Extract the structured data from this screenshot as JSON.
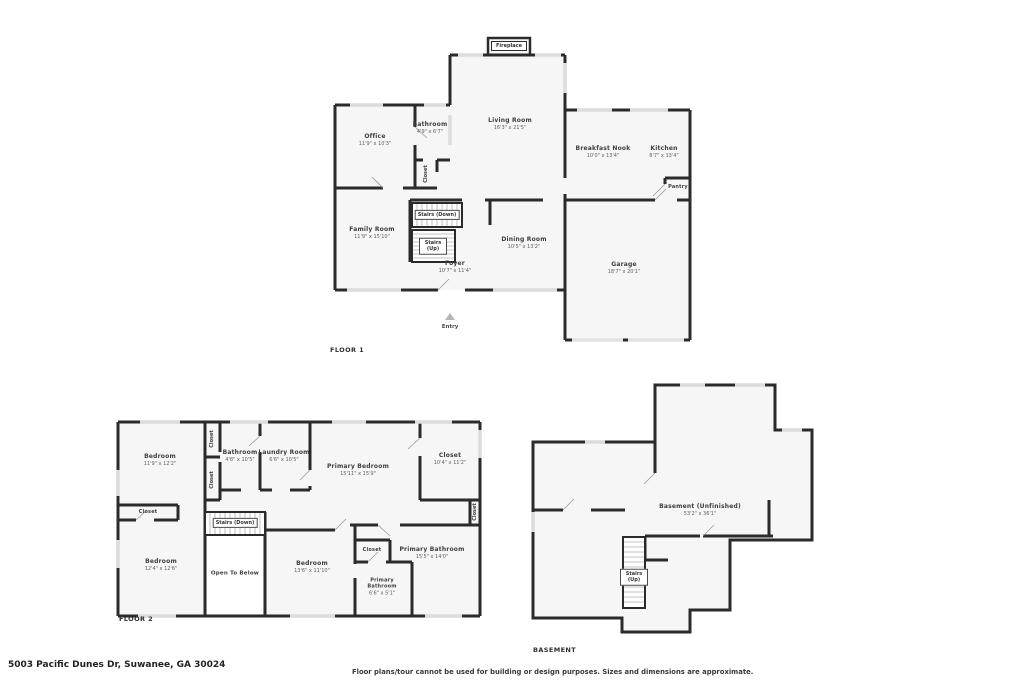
{
  "page": {
    "address": "5003 Pacific Dunes Dr, Suwanee, GA 30024",
    "disclaimer": "Floor plans/tour cannot be used for building or design purposes. Sizes and dimensions are approximate.",
    "wall_color": "#2b2b2b",
    "window_color": "#dcdcdc",
    "floor_fill": "#f6f6f6"
  },
  "floor1": {
    "title": "FLOOR 1",
    "fireplace": "Fireplace",
    "entry": "Entry",
    "rooms": {
      "office": {
        "name": "Office",
        "dims": "11'9\" x 10'3\""
      },
      "bathroom": {
        "name": "Bathroom",
        "dims": "4'9\" x 6'7\""
      },
      "closet": {
        "name": "Closet"
      },
      "living_room": {
        "name": "Living Room",
        "dims": "16'3\" x 21'5\""
      },
      "breakfast_nook": {
        "name": "Breakfast Nook",
        "dims": "10'0\" x 13'4\""
      },
      "kitchen": {
        "name": "Kitchen",
        "dims": "8'7\" x 13'4\""
      },
      "pantry": {
        "name": "Pantry"
      },
      "family_room": {
        "name": "Family Room",
        "dims": "11'9\" x 15'10\""
      },
      "stairs_down": {
        "name": "Stairs (Down)"
      },
      "stairs_up": {
        "name": "Stairs (Up)"
      },
      "dining_room": {
        "name": "Dining Room",
        "dims": "10'5\" x 13'2\""
      },
      "foyer": {
        "name": "Foyer",
        "dims": "10'7\" x 11'4\""
      },
      "garage": {
        "name": "Garage",
        "dims": "18'7\" x 20'1\""
      }
    }
  },
  "floor2": {
    "title": "FLOOR 2",
    "rooms": {
      "bedroom1": {
        "name": "Bedroom",
        "dims": "11'9\" x 12'2\""
      },
      "closet_a": {
        "name": "Closet"
      },
      "closet_b": {
        "name": "Closet"
      },
      "bathroom": {
        "name": "Bathroom",
        "dims": "4'8\" x 10'5\""
      },
      "laundry_room": {
        "name": "Laundry Room",
        "dims": "6'6\" x 10'5\""
      },
      "primary_bedroom": {
        "name": "Primary Bedroom",
        "dims": "15'11\" x 15'9\""
      },
      "closet_primary": {
        "name": "Closet",
        "dims": "10'4\" x 11'2\""
      },
      "closet_left": {
        "name": "Closet"
      },
      "stairs_down": {
        "name": "Stairs (Down)"
      },
      "open_to_below": {
        "name": "Open To Below"
      },
      "bedroom2": {
        "name": "Bedroom",
        "dims": "12'4\" x 12'6\""
      },
      "bedroom3": {
        "name": "Bedroom",
        "dims": "13'6\" x 11'10\""
      },
      "closet_mid": {
        "name": "Closet"
      },
      "primary_bathroom": {
        "name": "Primary Bathroom",
        "dims": "15'5\" x 14'0\""
      },
      "primary_bathroom_small": {
        "name": "Primary Bathroom",
        "dims": "6'6\" x 5'1\""
      },
      "closet_right": {
        "name": "Closet"
      }
    }
  },
  "basement": {
    "title": "BASEMENT",
    "rooms": {
      "basement_unfinished": {
        "name": "Basement (Unfinished)",
        "dims": "53'2\" x 36'1\""
      },
      "stairs_up": {
        "name": "Stairs (Up)"
      }
    }
  }
}
